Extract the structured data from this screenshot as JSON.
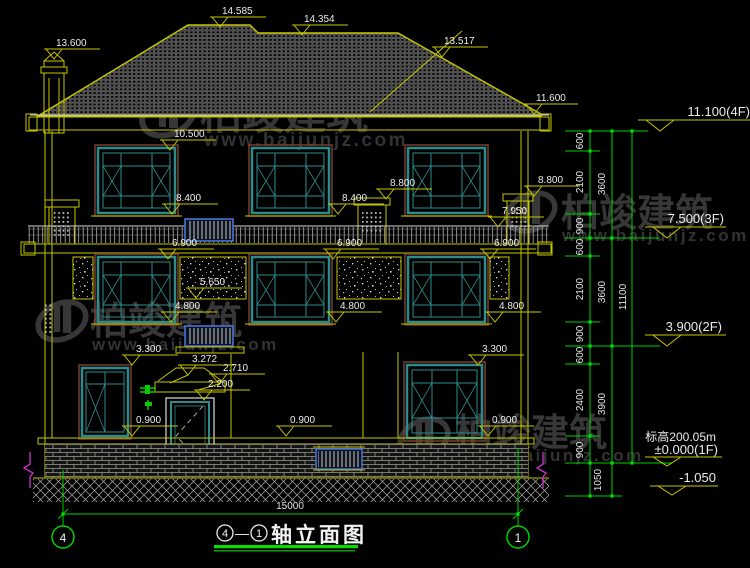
{
  "watermark": {
    "brand": "柏竣建筑",
    "url": "www.baijunjz.com"
  },
  "markers": {
    "chimney": "13.600",
    "ridge_main": "14.585",
    "ridge_secondary": "14.354",
    "roof_hip": "13.517",
    "eave_right": "11.600",
    "win3f_top": "10.500",
    "win3f_sill_left": "8.400",
    "win3f_sill_mid": "8.400",
    "stack_mid": "8.800",
    "stack_right": "8.800",
    "railing_top": "7.950",
    "win2f_top_left": "6.900",
    "win2f_top_mid": "6.900",
    "win2f_top_right": "6.900",
    "stone_band": "5.650",
    "win2f_sill_left": "4.800",
    "win2f_sill_mid": "4.800",
    "win2f_sill_right": "4.800",
    "win1f_top_left": "3.300",
    "win1f_top_right": "3.300",
    "canopy_top": "3.272",
    "canopy_edge": "2.710",
    "door_top": "2.200",
    "win1f_sill_left": "0.900",
    "win1f_sill_mid": "0.900",
    "win1f_sill_right": "0.900"
  },
  "levels": {
    "f4": "11.100(4F)",
    "f3": "7.500(3F)",
    "f2": "3.900(2F)",
    "note": "标高200.05m",
    "f1": "±0.000(1F)",
    "below": "-1.050"
  },
  "dims": {
    "col1": [
      "600",
      "2100",
      "900",
      "600",
      "2100",
      "900",
      "600",
      "2400",
      "900"
    ],
    "col2": [
      "3600",
      "3600",
      "3900"
    ],
    "below_zero": "1050",
    "overall_height": "11100",
    "overall_width": "15000"
  },
  "axes": {
    "left": "4",
    "right": "1"
  },
  "title": {
    "axis_start": "4",
    "separator": "—",
    "axis_end": "1",
    "name": "轴立面图"
  }
}
